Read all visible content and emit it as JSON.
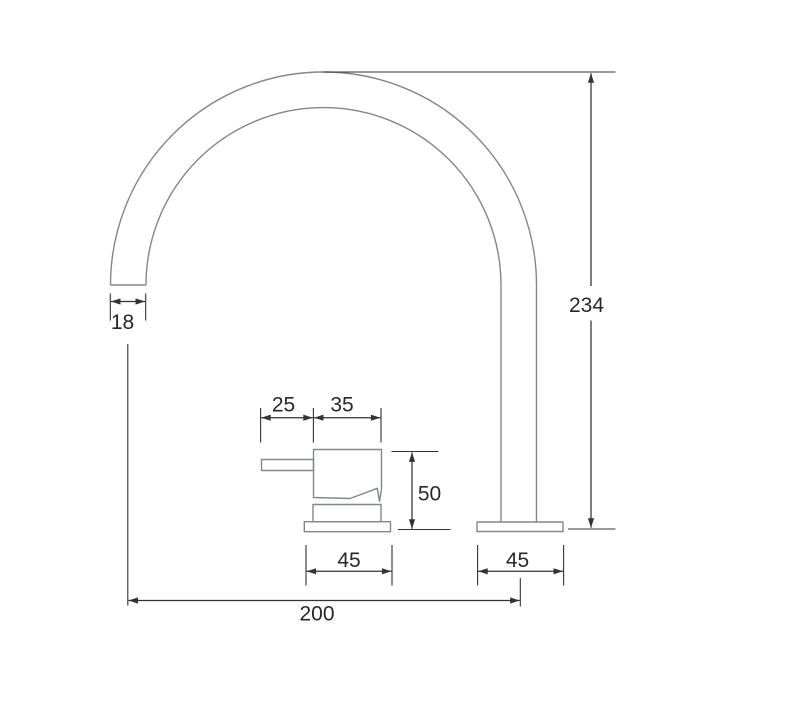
{
  "drawing": {
    "kind": "dimensioned technical line drawing",
    "subject": "gooseneck spout tap with separate lever handle, side elevation"
  },
  "colors": {
    "background": "#ffffff",
    "part_line": "#82878b",
    "dimension_line": "#323237",
    "text": "#27272c"
  },
  "dims": {
    "spout_tip_width": {
      "label": "18"
    },
    "overall_height": {
      "label": "234"
    },
    "lever_overhang": {
      "label": "25"
    },
    "handle_body_width": {
      "label": "35"
    },
    "handle_height": {
      "label": "50"
    },
    "handle_base_width": {
      "label": "45"
    },
    "spout_base_width": {
      "label": "45"
    },
    "spout_reach": {
      "label": "200"
    }
  }
}
